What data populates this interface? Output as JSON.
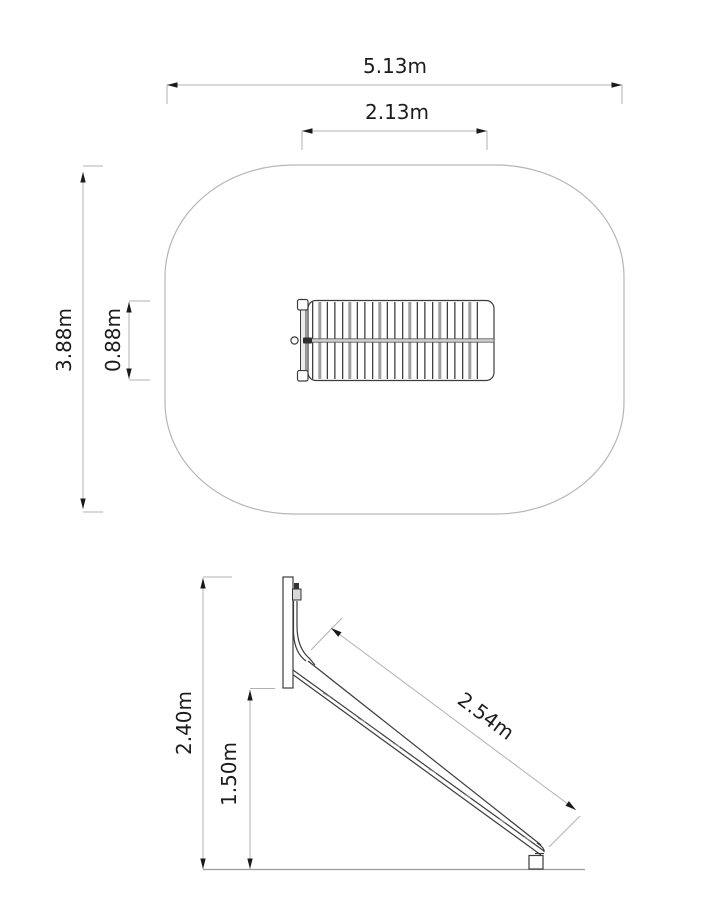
{
  "drawing": {
    "background": "#ffffff",
    "colors": {
      "equipment_line": "#3c3c3c",
      "dimension_line": "#b2b2b2",
      "arrowhead": "#1a1a1a",
      "text": "#1c1c1c",
      "safety_zone_outline": "#b6b6b6"
    },
    "plan_view": {
      "safety_zone_width_label": "5.13m",
      "equipment_width_label": "2.13m",
      "safety_zone_depth_label": "3.88m",
      "equipment_depth_label": "0.88m"
    },
    "side_view": {
      "overall_height_label": "2.40m",
      "platform_height_label": "1.50m",
      "slide_length_label": "2.54m"
    }
  }
}
